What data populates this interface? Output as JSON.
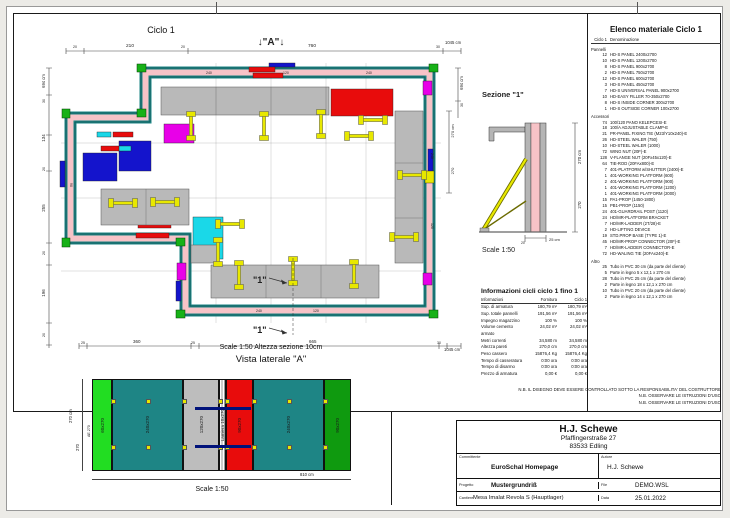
{
  "colors": {
    "teal_panel": "#1e8585",
    "wall_fill": "#f7c3c7",
    "green_panel": "#17b117",
    "dark_green": "#0f9a0f",
    "red_panel": "#e80c0c",
    "magenta_panel": "#e800e8",
    "blue_panel": "#1414cc",
    "cyan_panel": "#1ad8e8",
    "gray_platform": "#b9b9b9",
    "prop_yellow": "#e8e800",
    "tie_blue": "#00127a"
  },
  "plan": {
    "title": "Ciclo 1",
    "marker_a": "↓\"A\"↓",
    "marker_1": "\"1\"",
    "scale_note": "Scale 1:50   Altezza sezione 10cm",
    "dims": {
      "top_small_left": "20",
      "top_seg1": "210",
      "top_small_mid": "20",
      "top_seg2": "760",
      "top_small_right": "30",
      "top_total": "1045 cm",
      "left_total": "694 cm",
      "left_s1": "30",
      "left_s2": "134",
      "left_s3": "20",
      "left_s4": "255",
      "left_s5": "20",
      "left_s6": "196",
      "left_s7": "20",
      "bottom_s1": "25",
      "bottom_s2": "360",
      "bottom_s3": "25",
      "bottom_s4": "665",
      "bottom_s5": "30",
      "bottom_total": "1045 cm",
      "right_total": "694 cm",
      "right_s1": "30",
      "cut_offset_total": "270 cm",
      "cut_offset": "270"
    },
    "wall_labels": [
      {
        "t": "240",
        "x": 185,
        "y": 51,
        "r": 0
      },
      {
        "t": "120",
        "x": 262,
        "y": 51,
        "r": 0
      },
      {
        "t": "240",
        "x": 345,
        "y": 51,
        "r": 0
      },
      {
        "t": "240",
        "x": 410,
        "y": 130,
        "r": 90
      },
      {
        "t": "120",
        "x": 410,
        "y": 200,
        "r": 90
      },
      {
        "t": "240",
        "x": 235,
        "y": 289,
        "r": 0
      },
      {
        "t": "120",
        "x": 292,
        "y": 289,
        "r": 0
      },
      {
        "t": "90",
        "x": 49,
        "y": 160,
        "r": 90
      }
    ]
  },
  "section": {
    "title": "Sezione \"1\"",
    "scale": "Scale 1:50",
    "dims": {
      "height_total": "270 cm",
      "height": "270",
      "base": "25 cm",
      "base_small": "20"
    }
  },
  "side_view": {
    "title": "Vista laterale \"A\"",
    "scale": "Scale 1:50",
    "edge_label": "AE 270",
    "dims": {
      "height_total": "270 cm",
      "height": "270",
      "width_total": "810 cm"
    },
    "panels": [
      {
        "label": "60x270",
        "color": "#22dd22",
        "w": 20
      },
      {
        "label": "240x270",
        "color": "#1e8585",
        "w": 71
      },
      {
        "label": "120x270",
        "color": "#bdbdbd",
        "w": 36
      },
      {
        "label": "Lamiera 10x270",
        "color": "#ffffff",
        "w": 7
      },
      {
        "label": "90x270",
        "color": "#e80c0c",
        "w": 27
      },
      {
        "label": "240x270",
        "color": "#1e8585",
        "w": 71
      },
      {
        "label": "90x270",
        "color": "#0f9a0f",
        "w": 27
      }
    ]
  },
  "material_list": {
    "title": "Elenco materiale  Ciclo 1",
    "header_qty": "Ciclo 1",
    "header_name": "Denominazione",
    "groups": [
      {
        "name": "Pannelli",
        "items": [
          {
            "qty": "12",
            "name": "HD-S PANEL 2400x2700"
          },
          {
            "qty": "10",
            "name": "HD-S PANEL 1200x2700"
          },
          {
            "qty": "8",
            "name": "HD-S PANEL 900x2700"
          },
          {
            "qty": "2",
            "name": "HD-S PANEL 750x2700"
          },
          {
            "qty": "12",
            "name": "HD-S PANEL 600x2700"
          },
          {
            "qty": "3",
            "name": "HD-S PANEL 450x2700"
          },
          {
            "qty": "7",
            "name": "HD-S UNIVERSAL PANEL 900x2700"
          },
          {
            "qty": "10",
            "name": "HD-EASY FILLER 70-350x2700"
          },
          {
            "qty": "8",
            "name": "HD-S INSIDE CORNER 300x2700"
          },
          {
            "qty": "1",
            "name": "HD-S OUTSIDE CORNER 100x2700"
          }
        ]
      },
      {
        "name": "Accessori",
        "items": [
          {
            "qty": "74",
            "name": "100/120 PANO KELEPCESI-E"
          },
          {
            "qty": "18",
            "name": "100/A ADJUSTABLE CLAMP-E"
          },
          {
            "qty": "21",
            "name": "PR-PANEL FIXING TIE (M23/Y10x240)-E"
          },
          {
            "qty": "26",
            "name": "HD-STEEL WALER (750)"
          },
          {
            "qty": "10",
            "name": "HD-STEEL WALER (1000)"
          },
          {
            "qty": "72",
            "name": "WING NUT (20F)-E"
          },
          {
            "qty": "128",
            "name": "V-FLANGE NUT (20Fx45x120)-E"
          },
          {
            "qty": "64",
            "name": "TIE-ROD (20FAx800)-E"
          },
          {
            "qty": "7",
            "name": "401-PLATFORM w/SHUTTER (2400)-E"
          },
          {
            "qty": "1",
            "name": "401-WORKING PLATFORM (600)"
          },
          {
            "qty": "2",
            "name": "401-WORKING PLATFORM (900)"
          },
          {
            "qty": "1",
            "name": "401-WORKING PLATFORM (1200)"
          },
          {
            "qty": "1",
            "name": "401-WORKING PLATFORM (2000)"
          },
          {
            "qty": "15",
            "name": "PA1-PROP (1450-1800)"
          },
          {
            "qty": "15",
            "name": "PB1-PROP (1150)"
          },
          {
            "qty": "24",
            "name": "401-GUARDRAIL POST (1120)"
          },
          {
            "qty": "24",
            "name": "HD/MR-PLATFORM BRACKET"
          },
          {
            "qty": "7",
            "name": "HD/MR-LADDER (2T/28)-E"
          },
          {
            "qty": "2",
            "name": "HD-LIFTING DEVICE"
          },
          {
            "qty": "19",
            "name": "STD.PROP BASE (TYPE 1)-E"
          },
          {
            "qty": "45",
            "name": "HD/MR-PROP CONNECTOR (20F)-E"
          },
          {
            "qty": "7",
            "name": "HD/MR-LADDER CONNECTOR-E"
          },
          {
            "qty": "72",
            "name": "HD-WALING TIE (20FAx240)-E"
          }
        ]
      },
      {
        "name": "Altro",
        "items": [
          {
            "qty": "25",
            "name": "Tubo in PVC 30 cm (da parte del cliente)"
          },
          {
            "qty": "5",
            "name": "Parte in legno 5 x 12,1 x 270 cm"
          },
          {
            "qty": "28",
            "name": "Tubo in PVC 25 cm (da parte del cliente)"
          },
          {
            "qty": "2",
            "name": "Parte in legno 18 x 12,1 x 270 cm"
          },
          {
            "qty": "10",
            "name": "Tubo in PVC 20 cm (da parte del cliente)"
          },
          {
            "qty": "2",
            "name": "Parte in legno 14 x 12,1 x 270 cm"
          }
        ]
      }
    ]
  },
  "info_table": {
    "title": "Informazioni cicli  ciclo 1 fino 1",
    "col_info": "Informazioni",
    "col_forn": "Fornitura",
    "col_ciclo": "Ciclo 1",
    "rows": [
      {
        "label": "Sup. di armatura",
        "forn": "180,79 m²",
        "ciclo": "180,79 m²"
      },
      {
        "label": "Sup. totale pannelli",
        "forn": "191,56 m²",
        "ciclo": "191,56 m²"
      },
      {
        "label": "Impegno magazzino",
        "forn": "100 %",
        "ciclo": "100 %"
      },
      {
        "label": "Volume cemento armato",
        "forn": "24,02 m³",
        "ciclo": "24,02 m³"
      },
      {
        "label": "Metri correnti",
        "forn": "34,580 m",
        "ciclo": "34,580 m"
      },
      {
        "label": "Altezza pareti",
        "forn": "270,0 cm",
        "ciclo": "270,0 cm"
      },
      {
        "label": "Peso cassero",
        "forn": "15876,4 Kg",
        "ciclo": "15876,4 Kg"
      },
      {
        "label": "Tempo di casseratura",
        "forn": "0:00 ora",
        "ciclo": "0:00 ora"
      },
      {
        "label": "Tempo di disarmo",
        "forn": "0:00 ora",
        "ciclo": "0:00 ora"
      },
      {
        "label": "Prezzo di armatura",
        "forn": "0,00 €",
        "ciclo": "0,00 €"
      }
    ]
  },
  "notes": [
    "N.B. IL DISEGNO DEVE ESSERE CONTROLLATO SOTTO LA RESPONSABILITA' DEL COSTRUTTORE",
    "N.B. OSSERVARE LE ISTRUZIONI D'USO",
    "N.B. OSSERVARE LE ISTRUZIONI D'USO"
  ],
  "title_block": {
    "company": "H.J. Schewe",
    "address1": "Pfaffingerstraße 27",
    "address2": "83533 Edling",
    "committente_label": "Committente",
    "committente": "EuroSchal Homepage",
    "autore_label": "Autore",
    "autore": "H.J. Schewe",
    "progetto_label": "Progetto",
    "progetto": "Mustergrundriß",
    "file_label": "File",
    "file": "DEMO.WSL",
    "cantiere_label": "Cantiere",
    "cantiere": "Mesa Imalat Revola S (Hauptlager)",
    "data_label": "Data",
    "data": "25.01.2022"
  }
}
